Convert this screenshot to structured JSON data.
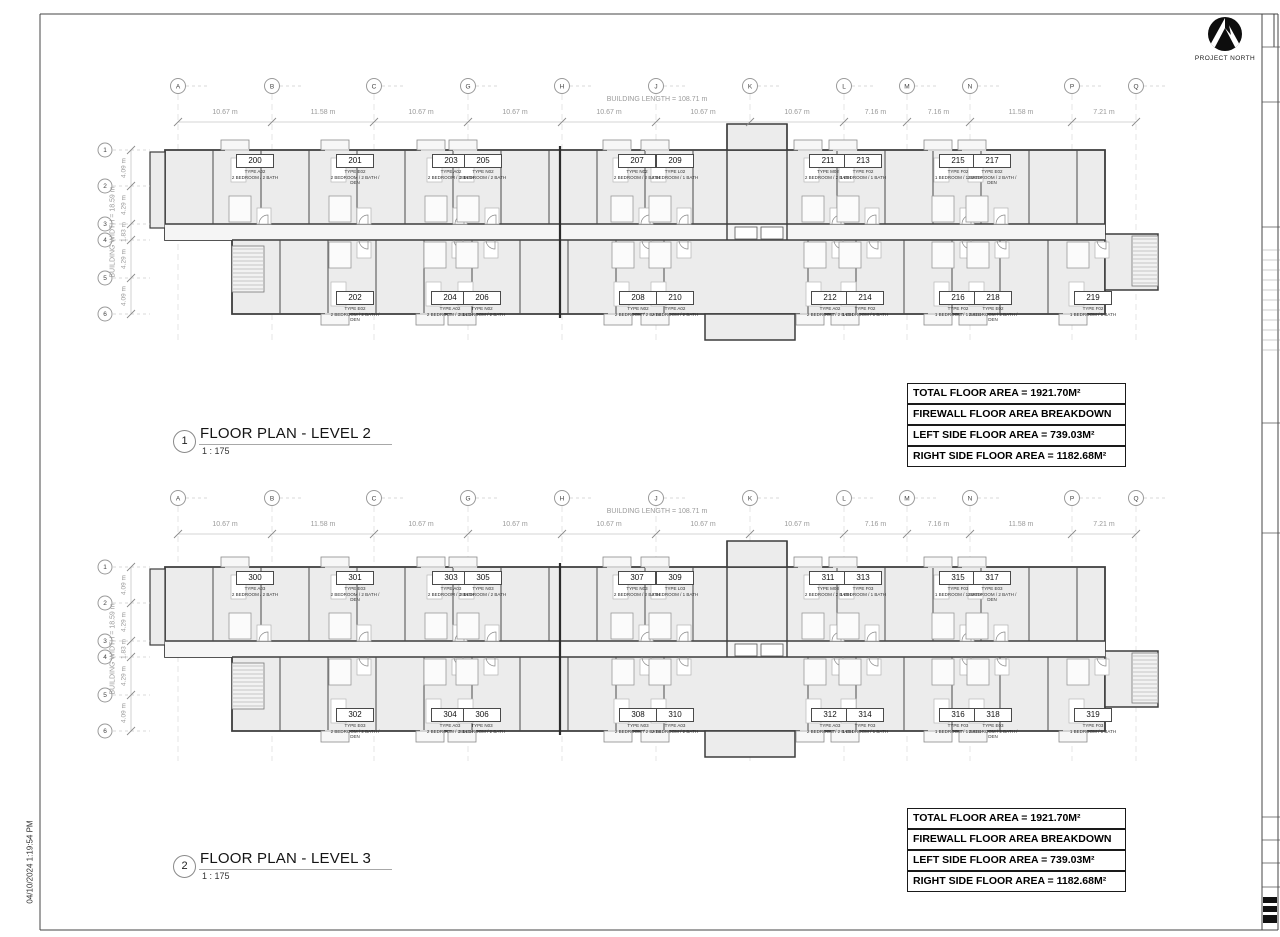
{
  "sheet": {
    "north_label": "PROJECT NORTH",
    "datestamp": "04/10/2024 1:19:54 PM"
  },
  "grid": {
    "columns": [
      "A",
      "B",
      "C",
      "G",
      "H",
      "J",
      "K",
      "L",
      "M",
      "N",
      "P",
      "Q"
    ],
    "column_x": [
      178,
      272,
      374,
      468,
      562,
      656,
      750,
      844,
      907,
      970,
      1072,
      1136
    ],
    "bay_widths": [
      "10.67 m",
      "11.58 m",
      "10.67 m",
      "10.67 m",
      "10.67 m",
      "10.67 m",
      "10.67 m",
      "7.16 m",
      "7.16 m",
      "11.58 m",
      "7.21 m"
    ],
    "building_length": "BUILDING LENGTH = 108.71 m",
    "rows": [
      "1",
      "2",
      "3",
      "4",
      "5",
      "6"
    ],
    "row_offsets": [
      0,
      36,
      74,
      90,
      128,
      164
    ],
    "row_heights": [
      "4.09 m",
      "4.29 m",
      "1.83 m",
      "4.29 m",
      "4.09 m"
    ],
    "building_width": "BUILDING WIDTH = 18.59 m"
  },
  "plans": [
    {
      "number": "1",
      "title": "FLOOR PLAN - LEVEL 2",
      "scale": "1 : 175",
      "area_lines": [
        "TOTAL FLOOR AREA = 1921.70M²",
        "FIREWALL FLOOR AREA BREAKDOWN",
        "LEFT SIDE FLOOR AREA = 739.03M²",
        "RIGHT SIDE FLOOR AREA = 1182.68M²"
      ],
      "units_top": [
        {
          "no": "200",
          "type": "TYPE A02",
          "desc": "2 BEDROOM / 2 BATH",
          "x": 255
        },
        {
          "no": "201",
          "type": "TYPE E02",
          "desc": "2 BEDROOM / 2 BATH / DEN",
          "x": 355
        },
        {
          "no": "203",
          "type": "TYPE A02",
          "desc": "2 BEDROOM / 2 BATH",
          "x": 451
        },
        {
          "no": "205",
          "type": "TYPE N02",
          "desc": "2 BEDROOM / 2 BATH",
          "x": 483
        },
        {
          "no": "207",
          "type": "TYPE N02",
          "desc": "2 BEDROOM / 2 BATH",
          "x": 637
        },
        {
          "no": "209",
          "type": "TYPE L02",
          "desc": "2 BEDROOM / 1 BATH",
          "x": 675
        },
        {
          "no": "211",
          "type": "TYPE M02",
          "desc": "2 BEDROOM / 2 BATH",
          "x": 828
        },
        {
          "no": "213",
          "type": "TYPE F02",
          "desc": "1 BEDROOM / 1 BATH",
          "x": 863
        },
        {
          "no": "215",
          "type": "TYPE F02",
          "desc": "1 BEDROOM / 1 BATH",
          "x": 958
        },
        {
          "no": "217",
          "type": "TYPE E02",
          "desc": "2 BEDROOM / 2 BATH / DEN",
          "x": 992
        }
      ],
      "units_bottom": [
        {
          "no": "202",
          "type": "TYPE E02",
          "desc": "2 BEDROOM / 2 BATH / DEN",
          "x": 355
        },
        {
          "no": "204",
          "type": "TYPE A02",
          "desc": "2 BEDROOM / 2 BATH",
          "x": 450
        },
        {
          "no": "206",
          "type": "TYPE N02",
          "desc": "2 BEDROOM / 2 BATH",
          "x": 482
        },
        {
          "no": "208",
          "type": "TYPE N02",
          "desc": "2 BEDROOM / 2 BATH",
          "x": 638
        },
        {
          "no": "210",
          "type": "TYPE A02",
          "desc": "2 BEDROOM / 2 BATH",
          "x": 675
        },
        {
          "no": "212",
          "type": "TYPE A02",
          "desc": "2 BEDROOM / 2 BATH",
          "x": 830
        },
        {
          "no": "214",
          "type": "TYPE F02",
          "desc": "1 BEDROOM / 1 BATH",
          "x": 865
        },
        {
          "no": "216",
          "type": "TYPE F02",
          "desc": "1 BEDROOM / 1 BATH",
          "x": 958
        },
        {
          "no": "218",
          "type": "TYPE E02",
          "desc": "2 BEDROOM / 2 BATH / DEN",
          "x": 993
        },
        {
          "no": "219",
          "type": "TYPE F02",
          "desc": "1 BEDROOM / 1 BATH",
          "x": 1093
        }
      ]
    },
    {
      "number": "2",
      "title": "FLOOR PLAN - LEVEL 3",
      "scale": "1 : 175",
      "area_lines": [
        "TOTAL FLOOR AREA = 1921.70M²",
        "FIREWALL FLOOR AREA BREAKDOWN",
        "LEFT SIDE FLOOR AREA = 739.03M²",
        "RIGHT SIDE FLOOR AREA = 1182.68M²"
      ],
      "units_top": [
        {
          "no": "300",
          "type": "TYPE A03",
          "desc": "2 BEDROOM / 2 BATH",
          "x": 255
        },
        {
          "no": "301",
          "type": "TYPE E03",
          "desc": "2 BEDROOM / 2 BATH / DEN",
          "x": 355
        },
        {
          "no": "303",
          "type": "TYPE A03",
          "desc": "2 BEDROOM / 2 BATH",
          "x": 451
        },
        {
          "no": "305",
          "type": "TYPE N03",
          "desc": "2 BEDROOM / 2 BATH",
          "x": 483
        },
        {
          "no": "307",
          "type": "TYPE N03",
          "desc": "2 BEDROOM / 2 BATH",
          "x": 637
        },
        {
          "no": "309",
          "type": "TYPE L03",
          "desc": "2 BEDROOM / 1 BATH",
          "x": 675
        },
        {
          "no": "311",
          "type": "TYPE M03",
          "desc": "2 BEDROOM / 2 BATH",
          "x": 828
        },
        {
          "no": "313",
          "type": "TYPE F03",
          "desc": "1 BEDROOM / 1 BATH",
          "x": 863
        },
        {
          "no": "315",
          "type": "TYPE F03",
          "desc": "1 BEDROOM / 1 BATH",
          "x": 958
        },
        {
          "no": "317",
          "type": "TYPE E03",
          "desc": "2 BEDROOM / 2 BATH / DEN",
          "x": 992
        }
      ],
      "units_bottom": [
        {
          "no": "302",
          "type": "TYPE E03",
          "desc": "2 BEDROOM / 2 BATH / DEN",
          "x": 355
        },
        {
          "no": "304",
          "type": "TYPE A03",
          "desc": "2 BEDROOM / 2 BATH",
          "x": 450
        },
        {
          "no": "306",
          "type": "TYPE N03",
          "desc": "2 BEDROOM / 2 BATH",
          "x": 482
        },
        {
          "no": "308",
          "type": "TYPE N03",
          "desc": "2 BEDROOM / 2 BATH",
          "x": 638
        },
        {
          "no": "310",
          "type": "TYPE A03",
          "desc": "2 BEDROOM / 2 BATH",
          "x": 675
        },
        {
          "no": "312",
          "type": "TYPE A03",
          "desc": "2 BEDROOM / 2 BATH",
          "x": 830
        },
        {
          "no": "314",
          "type": "TYPE F03",
          "desc": "1 BEDROOM / 1 BATH",
          "x": 865
        },
        {
          "no": "316",
          "type": "TYPE F03",
          "desc": "1 BEDROOM / 1 BATH",
          "x": 958
        },
        {
          "no": "318",
          "type": "TYPE E03",
          "desc": "2 BEDROOM / 2 BATH / DEN",
          "x": 993
        },
        {
          "no": "319",
          "type": "TYPE F03",
          "desc": "1 BEDROOM / 1 BATH",
          "x": 1093
        }
      ]
    }
  ]
}
